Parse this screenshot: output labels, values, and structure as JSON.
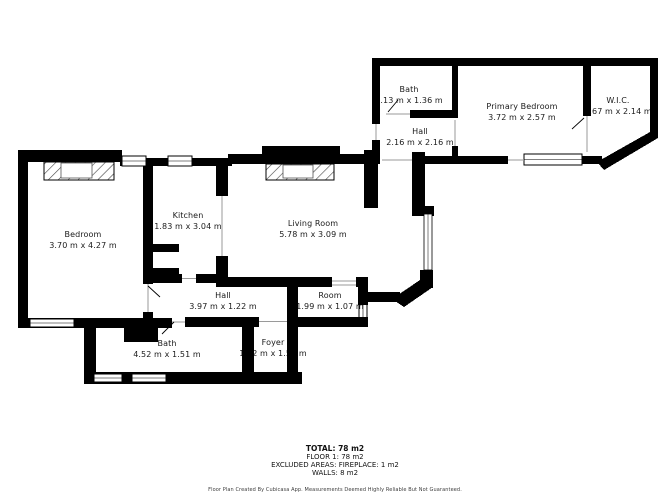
{
  "rooms": [
    {
      "id": "bath-upper",
      "name": "Bath",
      "dims": "1.13 m x 1.36 m"
    },
    {
      "id": "hall-upper",
      "name": "Hall",
      "dims": "2.16 m x 2.16 m"
    },
    {
      "id": "primary-bedroom",
      "name": "Primary Bedroom",
      "dims": "3.72 m x 2.57 m"
    },
    {
      "id": "wic",
      "name": "W.I.C.",
      "dims": "1.67 m x 2.14 m"
    },
    {
      "id": "bedroom",
      "name": "Bedroom",
      "dims": "3.70 m x 4.27 m"
    },
    {
      "id": "kitchen",
      "name": "Kitchen",
      "dims": "1.83 m x 3.04 m"
    },
    {
      "id": "living-room",
      "name": "Living Room",
      "dims": "5.78 m x 3.09 m"
    },
    {
      "id": "hall-lower",
      "name": "Hall",
      "dims": "3.97 m x 1.22 m"
    },
    {
      "id": "room",
      "name": "Room",
      "dims": "1.99 m x 1.07 m"
    },
    {
      "id": "bath-lower",
      "name": "Bath",
      "dims": "4.52 m x 1.51 m"
    },
    {
      "id": "foyer",
      "name": "Foyer",
      "dims": "1.12 m x 1.51 m"
    }
  ],
  "summary": {
    "total": "TOTAL: 78 m2",
    "floor": "FLOOR 1: 78 m2",
    "excluded": "EXCLUDED AREAS: FIREPLACE: 1 m2",
    "walls": "WALLS: 8 m2"
  },
  "footer": "Floor Plan Created By Cubicasa App. Measurements Deemed Highly Reliable But Not Guaranteed.",
  "colors": {
    "wall": "#000000",
    "background": "#ffffff",
    "text": "#1a1a1a",
    "opening": "#9a9a9a"
  }
}
